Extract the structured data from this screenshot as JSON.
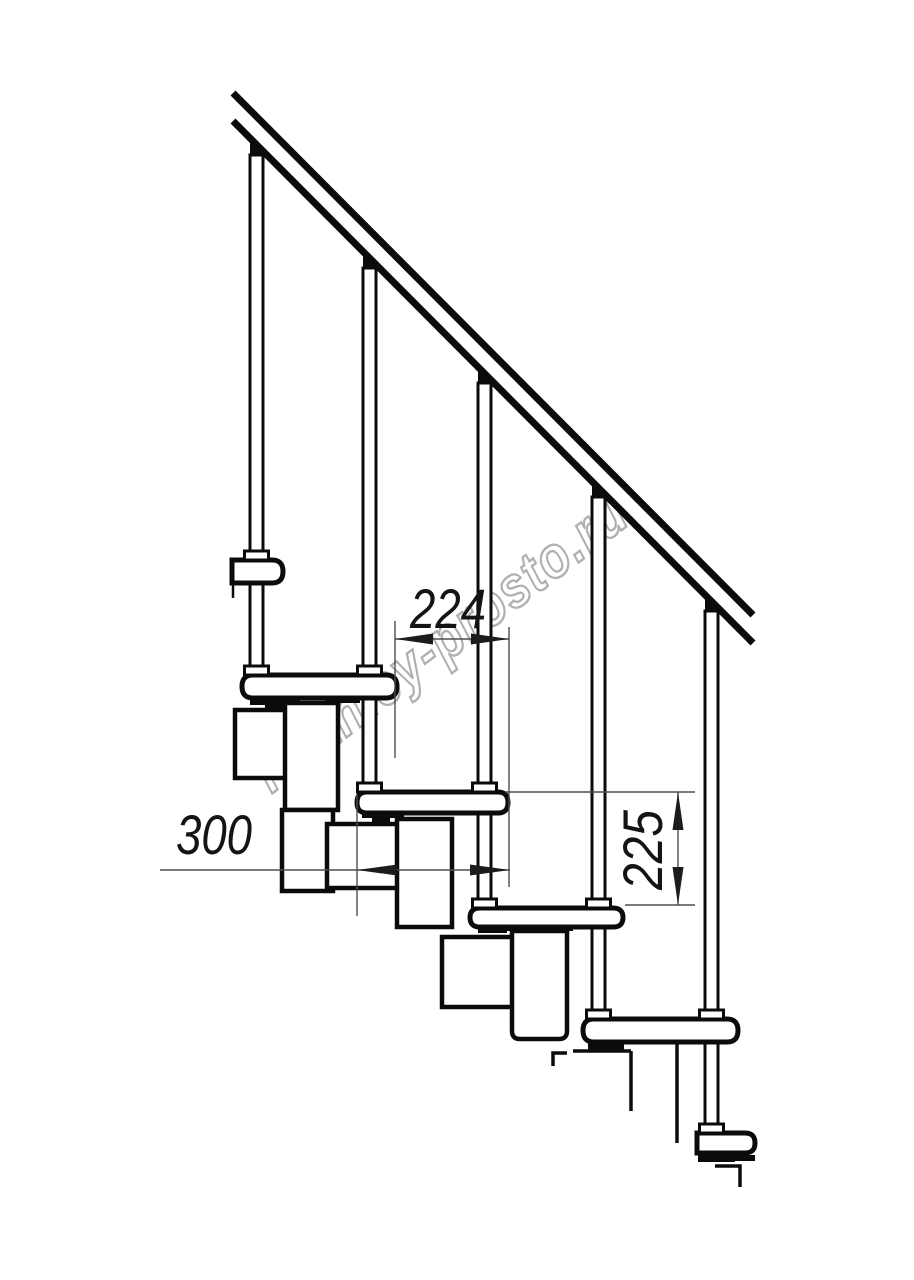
{
  "drawing": {
    "watermark": "lestnicy-prosto.ru",
    "dimensions": {
      "step_run_mm": "224",
      "step_depth_mm": "300",
      "step_rise_mm": "225"
    },
    "colors": {
      "line": "#0b0b0b",
      "dimension_line": "#4f4f4f",
      "dimension_text": "#141414",
      "watermark": "#b0b0b0",
      "background": "#ffffff"
    }
  }
}
